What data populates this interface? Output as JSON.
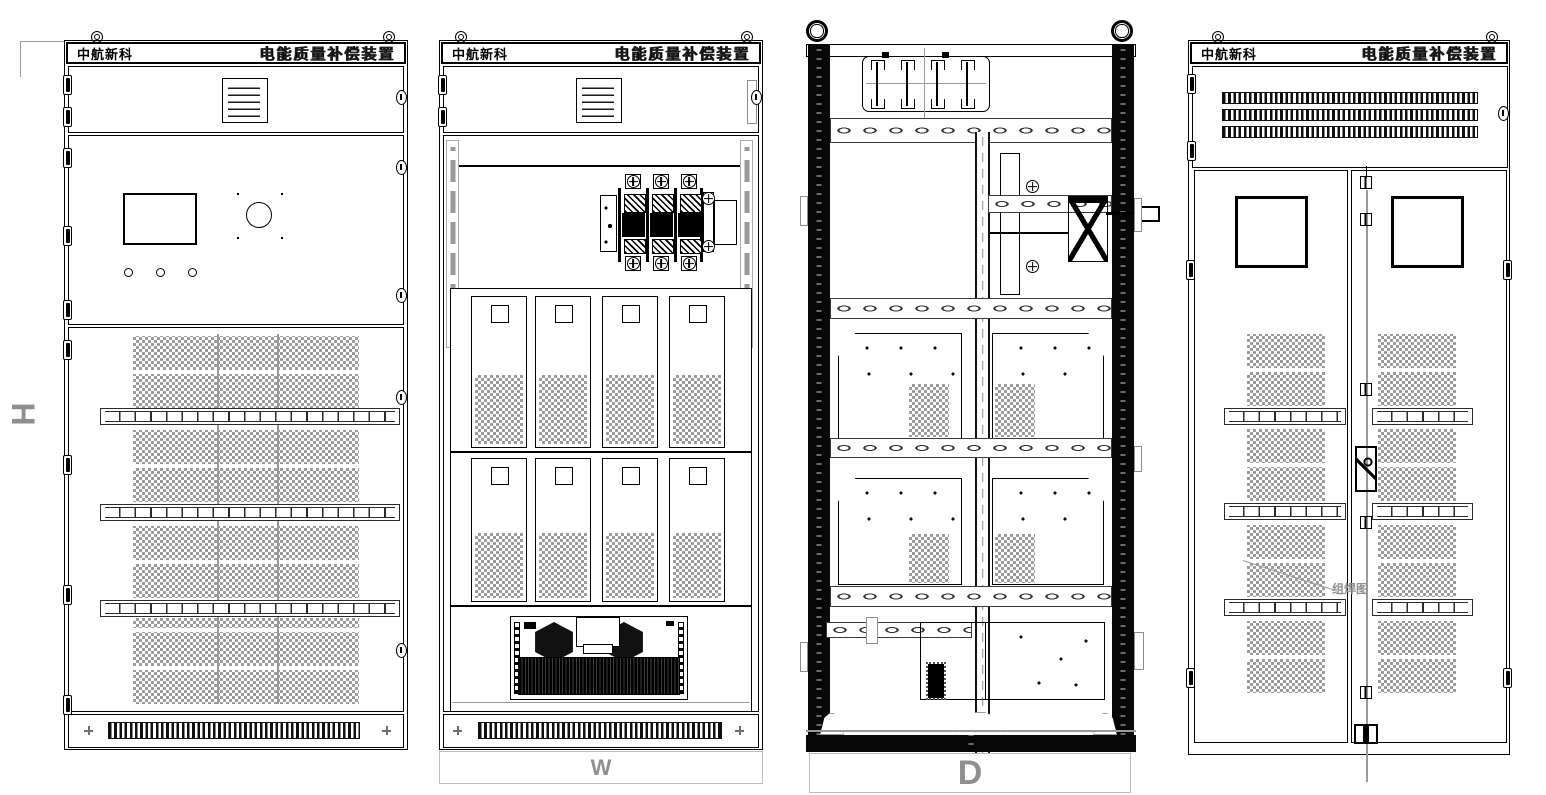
{
  "titlebar": {
    "brand": "中航新科",
    "product": "电能质量补偿装置"
  },
  "dimension_labels": {
    "height": "H",
    "width": "W",
    "depth": "D"
  },
  "callouts": {
    "weld_note": "组焊图"
  },
  "palette": {
    "line": "#000000",
    "mesh_gray": "#9c9c9c",
    "dim_gray": "#8f8f8f",
    "background": "#ffffff"
  }
}
